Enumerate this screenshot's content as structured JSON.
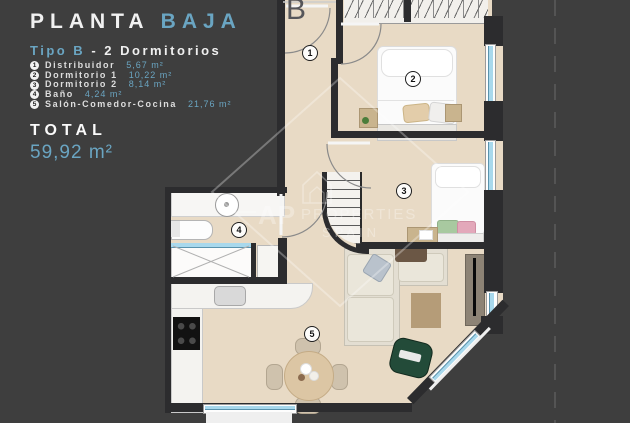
{
  "panel": {
    "title_primary": "PLANTA",
    "title_accent": "BAJA",
    "subtitle_accent": "Tipo B",
    "subtitle_rest": "- 2 Dormitorios",
    "legend": [
      {
        "num": "1",
        "name": "Distribuidor",
        "area": "5,67 m²"
      },
      {
        "num": "2",
        "name": "Dormitorio 1",
        "area": "10,22 m²"
      },
      {
        "num": "3",
        "name": "Dormitorio 2",
        "area": "8,14 m²"
      },
      {
        "num": "4",
        "name": "Baño",
        "area": "4,24 m²"
      },
      {
        "num": "5",
        "name": "Salón-Comedor-Cocina",
        "area": "21,76 m²"
      }
    ],
    "total_label": "TOTAL",
    "total_value": "59,92 m²"
  },
  "plan": {
    "block_label": "B",
    "rooms": [
      {
        "num": "1"
      },
      {
        "num": "2"
      },
      {
        "num": "3"
      },
      {
        "num": "4"
      },
      {
        "num": "5"
      }
    ]
  },
  "watermark": {
    "monogram": "AP",
    "name": "PROPERTIES",
    "country": "SPAIN"
  },
  "colors": {
    "background": "#3e3e3e",
    "accent_blue": "#6aa5c2",
    "floor": "#e8dac5",
    "wall": "#2c2c2e",
    "window_glass": "#a8d8ec",
    "armchair_green": "#234b39",
    "rug_tan": "#b59c78"
  }
}
